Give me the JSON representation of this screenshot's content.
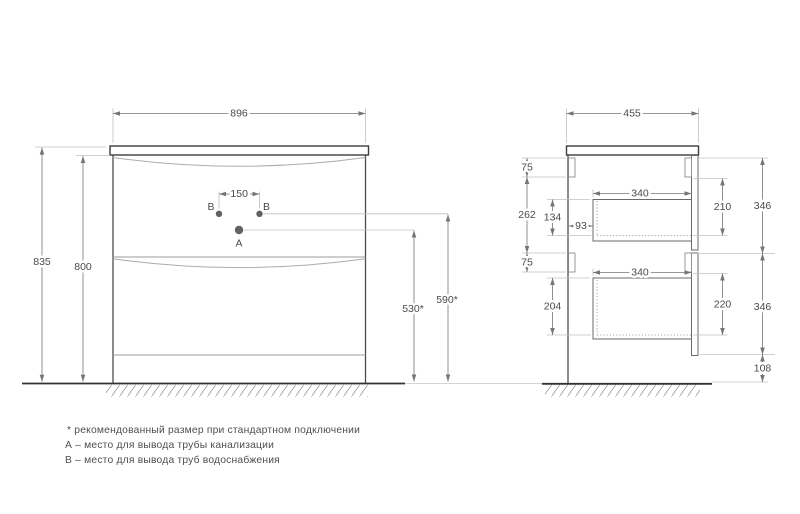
{
  "front": {
    "width": "896",
    "height_total": "835",
    "height_body": "800",
    "hole_spacing": "150",
    "siphon_height": "530*",
    "water_height": "590*",
    "label_a": "А",
    "label_b": "В"
  },
  "side": {
    "depth": "455",
    "gap_top": "75",
    "section_upper": "262",
    "drawer_upper_inner_depth": "134",
    "back_clearance": "93",
    "drawer_upper_length": "340",
    "drawer_upper_height": "210",
    "front_upper_height": "346",
    "gap_mid": "75",
    "drawer_lower_inner_depth": "204",
    "drawer_lower_length": "340",
    "drawer_lower_height": "220",
    "front_lower_height": "346",
    "floor_clearance": "108"
  },
  "notes": {
    "line1": "* рекомендованный размер при стандартном подключении",
    "line2": "А – место для вывода трубы канализации",
    "line3": "В – место для вывода труб водоснабжения"
  },
  "colors": {
    "outline": "#3d3d3d",
    "dim_line": "#757575",
    "dim_text": "#4a4a4a",
    "extension": "#c0c0c0",
    "hole_fill": "#616161",
    "floor": "#333333",
    "hatch": "#9e9e9e",
    "note_text": "#4f4f4f",
    "background": "#ffffff"
  }
}
